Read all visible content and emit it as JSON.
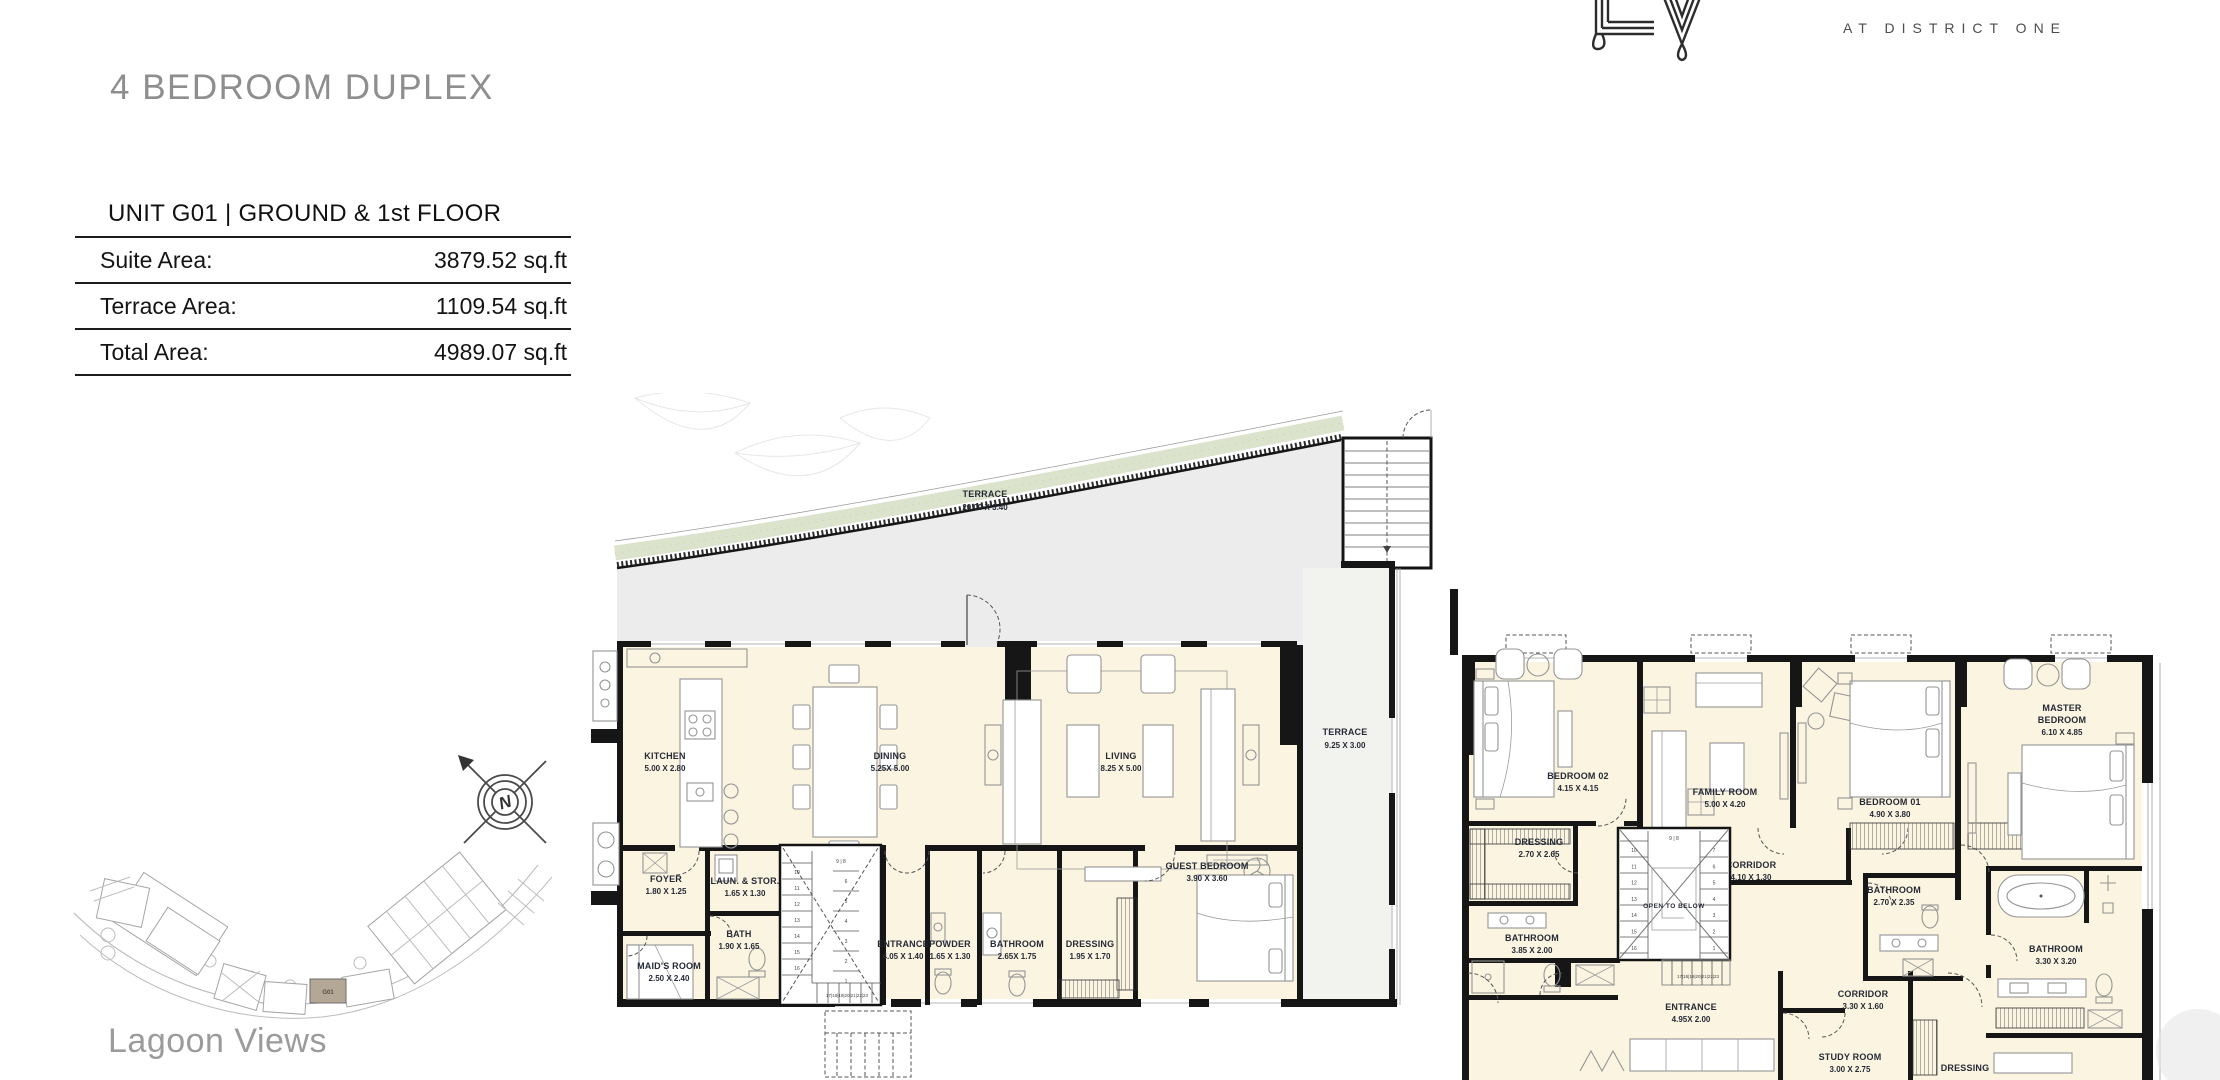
{
  "brand": {
    "monogram": "LV",
    "tagline": "AT DISTRICT ONE"
  },
  "title": "4 BEDROOM DUPLEX",
  "unit_info": {
    "header": "UNIT G01 | GROUND & 1st FLOOR",
    "rows": [
      {
        "label": "Suite Area:",
        "value": "3879.52 sq.ft"
      },
      {
        "label": "Terrace Area:",
        "value": "1109.54 sq.ft"
      },
      {
        "label": "Total Area:",
        "value": "4989.07 sq.ft"
      }
    ]
  },
  "site": {
    "caption": "Lagoon Views",
    "unit_marker": "G01",
    "compass_letter": "N"
  },
  "ground_floor": {
    "terrace_main": {
      "name": "TERRACE",
      "dim": "20.00 X 3.40"
    },
    "terrace_side": {
      "name": "TERRACE",
      "dim": "9.25 X 3.00"
    },
    "kitchen": {
      "name": "KITCHEN",
      "dim": "5.00 X 2.80"
    },
    "dining": {
      "name": "DINING",
      "dim": "5.25X 5.00"
    },
    "living": {
      "name": "LIVING",
      "dim": "8.25 X 5.00"
    },
    "foyer": {
      "name": "FOYER",
      "dim": "1.80 X 1.25"
    },
    "laundry": {
      "name": "LAUN. & STOR.",
      "dim": "1.65 X 1.30"
    },
    "bath": {
      "name": "BATH",
      "dim": "1.90 X 1.65"
    },
    "maids_room": {
      "name": "MAID'S ROOM",
      "dim": "2.50 X 2.40"
    },
    "entrance": {
      "name": "ENTRANCE",
      "dim": "4.05 X 1.40"
    },
    "powder": {
      "name": "POWDER",
      "dim": "1.65 X 1.30"
    },
    "bathroom": {
      "name": "BATHROOM",
      "dim": "2.65X 1.75"
    },
    "dressing": {
      "name": "DRESSING",
      "dim": "1.95 X 1.70"
    },
    "guest_bedroom": {
      "name": "GUEST BEDROOM",
      "dim": "3.90 X 3.60"
    },
    "stair_left_numbers": [
      "10",
      "11",
      "12",
      "13",
      "14",
      "15",
      "16"
    ],
    "stair_right_numbers": [
      "6",
      "5",
      "4",
      "3",
      "2",
      "1"
    ],
    "stair_top_numbers": "9 | 8",
    "stair_run_numbers": "17|18|19|20|21|22|23"
  },
  "first_floor": {
    "bedroom_02": {
      "name": "BEDROOM 02",
      "dim": "4.15 X 4.15"
    },
    "dressing_02": {
      "name": "DRESSING",
      "dim": "2.70 X 2.65"
    },
    "bathroom_02": {
      "name": "BATHROOM",
      "dim": "3.85 X 2.00"
    },
    "family_room": {
      "name": "FAMILY ROOM",
      "dim": "5.00 X 4.20"
    },
    "corridor_upper": {
      "name": "CORRIDOR",
      "dim": "4.10 X 1.30"
    },
    "stair_note": "OPEN TO BELOW",
    "bedroom_01": {
      "name": "BEDROOM 01",
      "dim": "4.90 X 3.80"
    },
    "bathroom_01": {
      "name": "BATHROOM",
      "dim": "2.70 X 2.35"
    },
    "master_bedroom": {
      "line1": "MASTER",
      "line2": "BEDROOM",
      "dim": "6.10 X 4.85"
    },
    "master_bathroom": {
      "name": "BATHROOM",
      "dim": "3.30 X 3.20"
    },
    "corridor_lower": {
      "name": "CORRIDOR",
      "dim": "3.30 X 1.60"
    },
    "entrance": {
      "name": "ENTRANCE",
      "dim": "4.95X 2.00"
    },
    "study_room": {
      "name": "STUDY ROOM",
      "dim": "3.00 X 2.75"
    },
    "master_dressing": {
      "name": "DRESSING"
    },
    "stair_left_numbers": [
      "10",
      "11",
      "12",
      "13",
      "14",
      "15",
      "16"
    ],
    "stair_right_numbers": [
      "7",
      "6",
      "5",
      "4",
      "3",
      "2",
      "1"
    ],
    "stair_top_numbers": "9 | 8",
    "stair_run_numbers": "17|18|19|20|21|22|23"
  }
}
